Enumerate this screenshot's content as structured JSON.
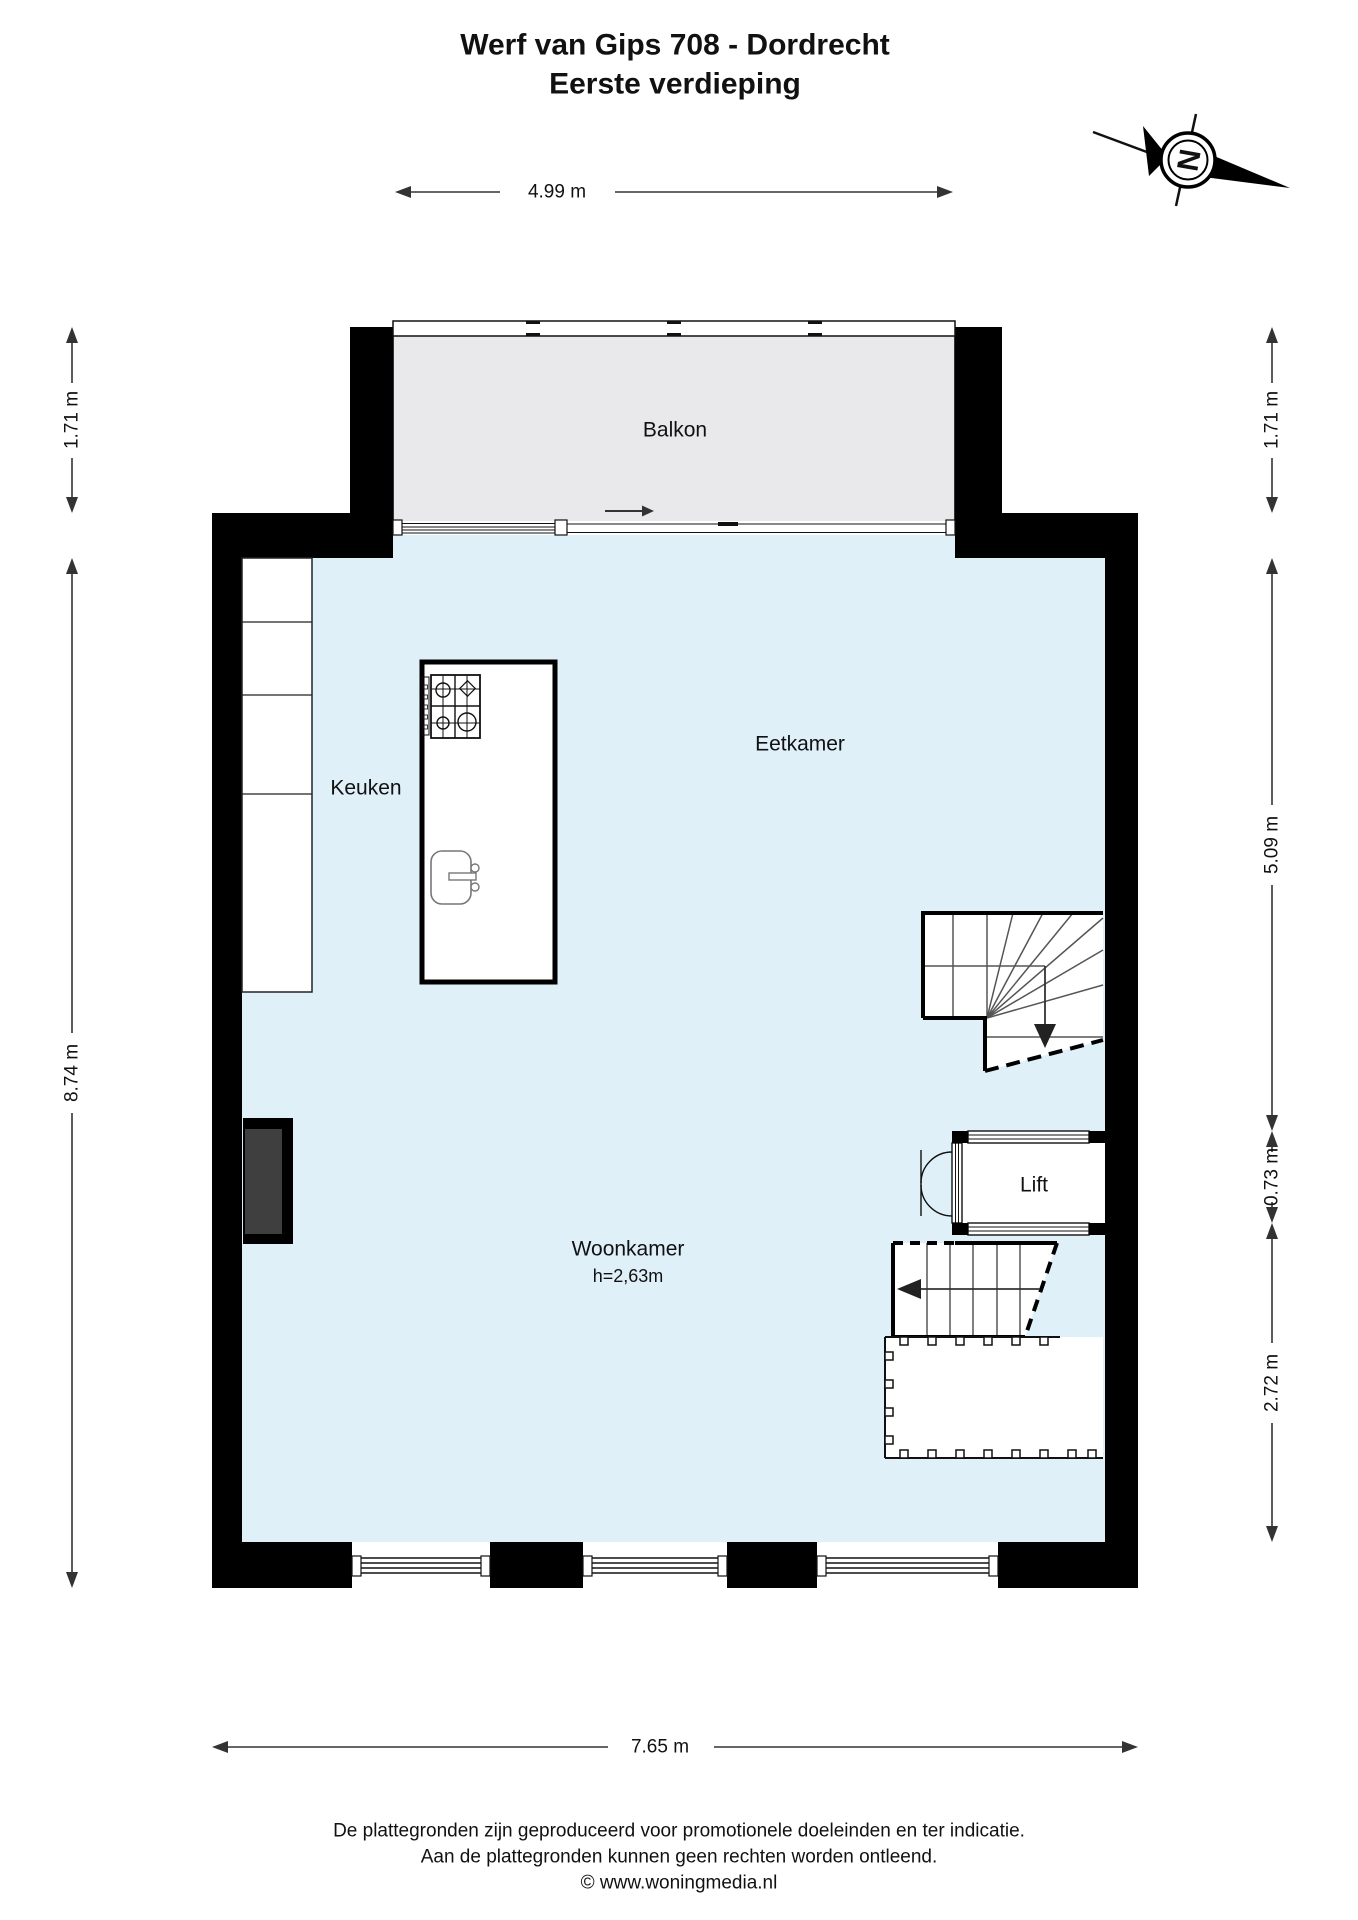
{
  "title": {
    "line1": "Werf van Gips 708 - Dordrecht",
    "line2": "Eerste verdieping"
  },
  "rooms": {
    "balkon": "Balkon",
    "keuken": "Keuken",
    "eetkamer": "Eetkamer",
    "woonkamer": "Woonkamer",
    "woonkamer_height": "h=2,63m",
    "lift": "Lift"
  },
  "dimensions": {
    "top_width": "4.99 m",
    "left_balcony": "1.71 m",
    "left_main": "8.74 m",
    "right_balcony": "1.71 m",
    "right_upper": "5.09 m",
    "right_lift": "0.73 m",
    "right_lower": "2.72 m",
    "bottom_width": "7.65 m"
  },
  "compass": {
    "north_label": "N"
  },
  "footer": {
    "line1": "De plattegronden zijn geproduceerd voor promotionele doeleinden en ter indicatie.",
    "line2": "Aan de plattegronden kunnen geen rechten worden ontleend.",
    "line3": "© www.woningmedia.nl"
  },
  "colors": {
    "wall": "#000000",
    "floor": "#e0f0f9",
    "balcony": "#e9e9eb",
    "chimney": "#3f3f3f"
  }
}
